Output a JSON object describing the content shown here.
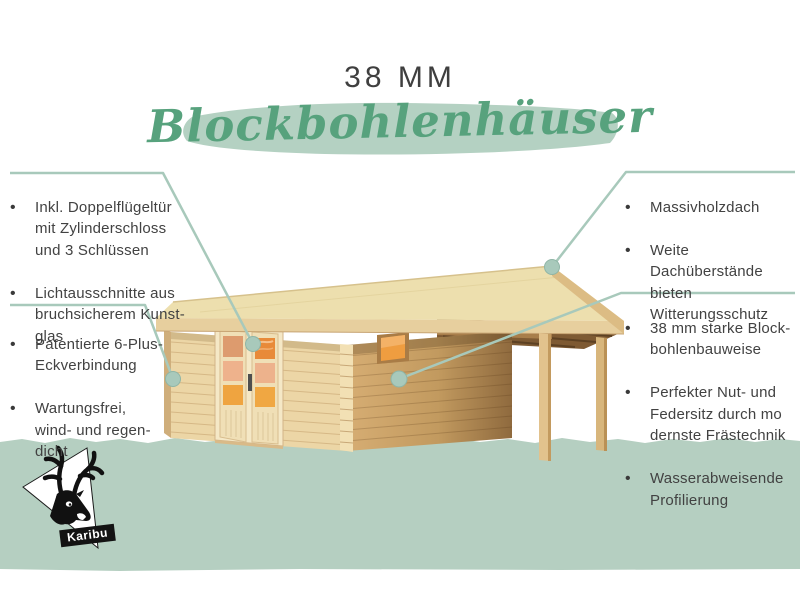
{
  "title": {
    "size_label": "38 MM",
    "product_label": "Blockbohlenhäuser"
  },
  "annotations": {
    "left_top": {
      "items": [
        "Inkl. Doppelflügeltür\nmit Zylinderschloss\nund 3 Schlüssen",
        "Lichtausschnitte aus\nbruchsicherem Kunst-\nglas"
      ]
    },
    "left_bottom": {
      "items": [
        "Patentierte 6-Plus-\nEckverbindung",
        "Wartungsfrei,\nwind- und regen-\ndicht"
      ]
    },
    "right_top": {
      "items": [
        "Massivholzdach",
        "Weite Dachüberstände\nbieten Witterungsschutz"
      ]
    },
    "right_bottom": {
      "items": [
        "38 mm starke Block-\nbohlenbauweise",
        "Perfekter Nut- und\nFedersitz durch mo\ndernste Frästechnik",
        "Wasserabweisende\nProfilierung"
      ]
    }
  },
  "logo": {
    "brand": "Karibu"
  },
  "colors": {
    "script_green": "#57a27d",
    "brush_green": "#b4d1c2",
    "ground_green": "#b5cfc1",
    "callout_line": "#a8c9bb",
    "text_gray": "#424242",
    "wood_light": "#ecd6a6",
    "wood_dark": "#8f6a3e",
    "glass_orange": "#efa041"
  }
}
